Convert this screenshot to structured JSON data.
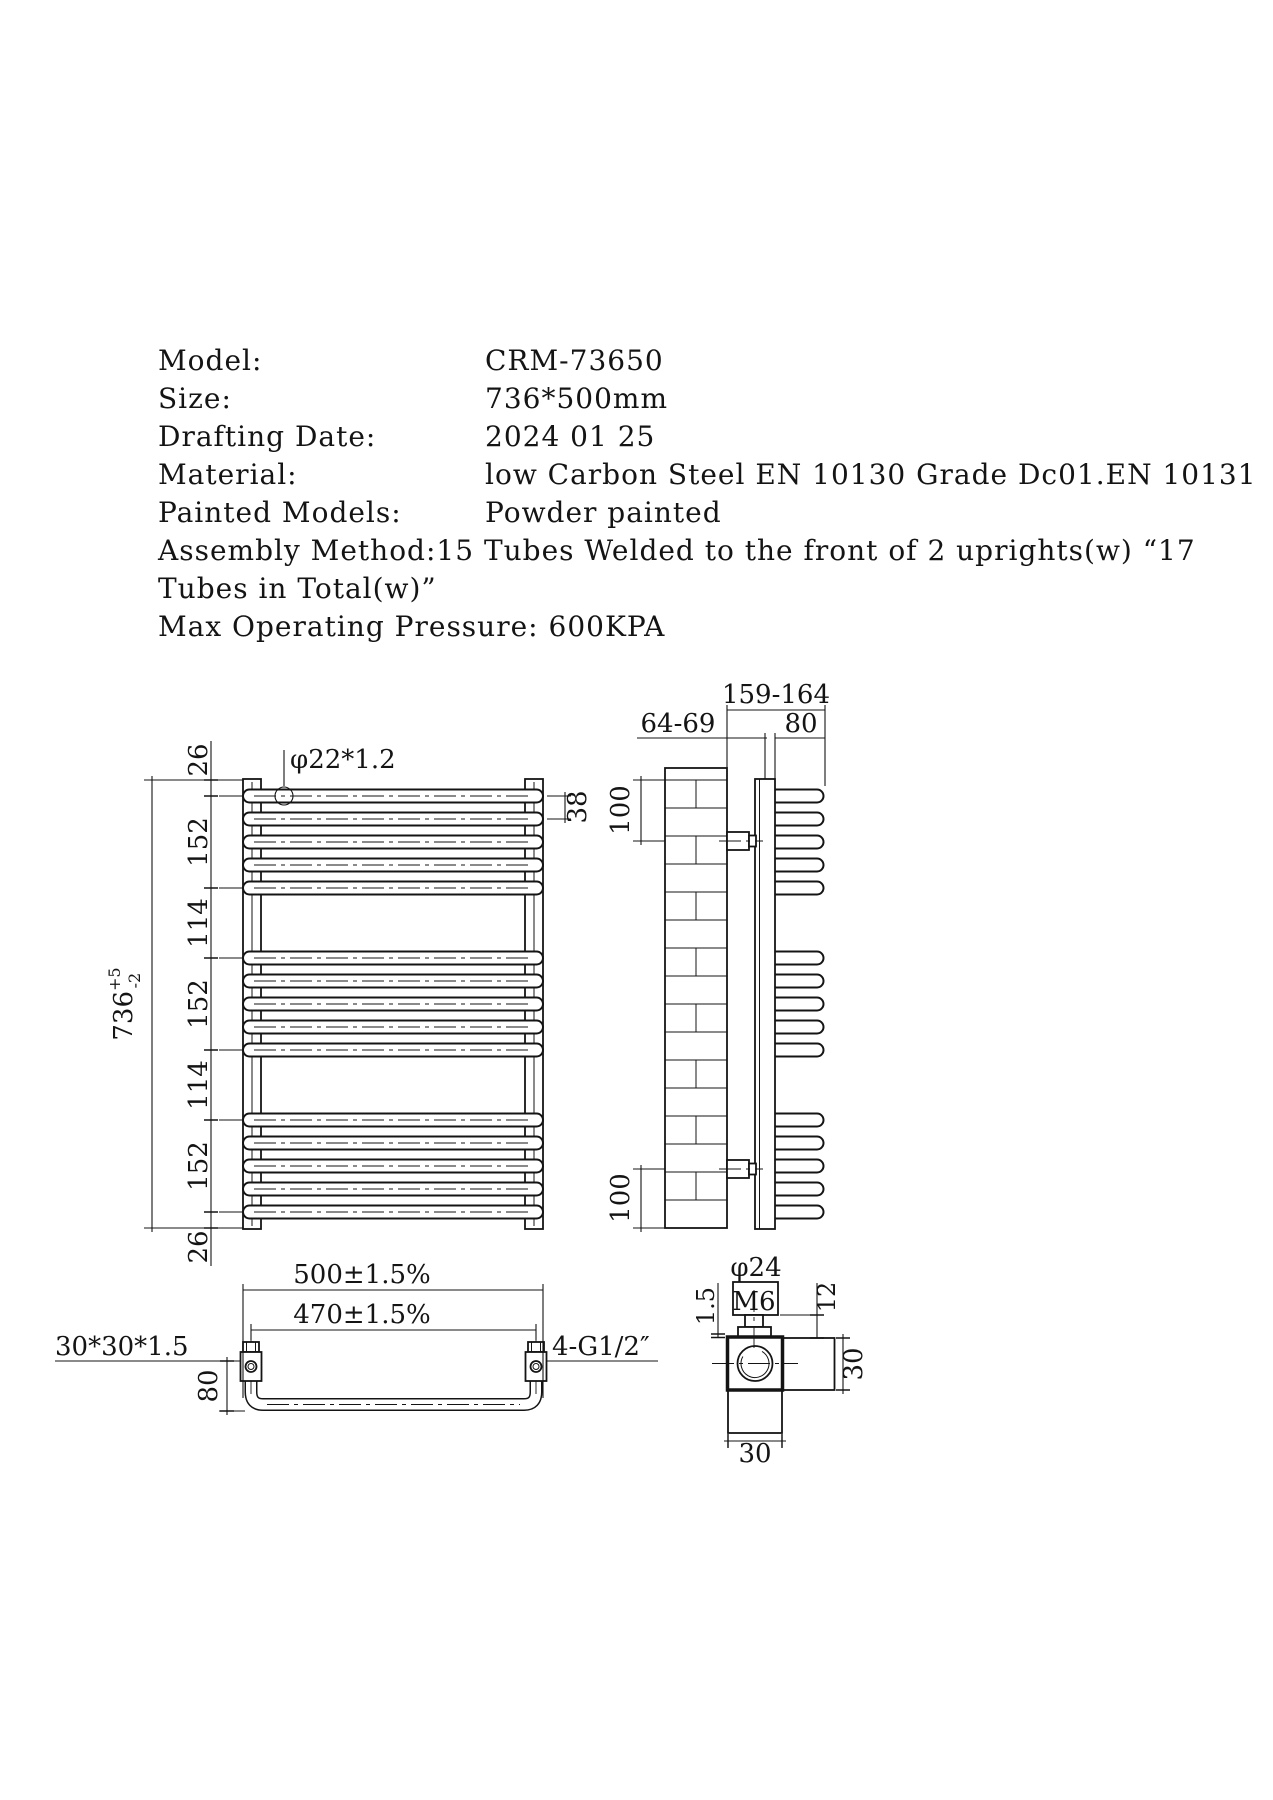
{
  "info": {
    "rows": [
      {
        "label": "Model:",
        "value": "CRM-73650"
      },
      {
        "label": "Size:",
        "value": "736*500mm"
      },
      {
        "label": "Drafting Date:",
        "value": "2024 01 25"
      },
      {
        "label": "Material:",
        "value": "low Carbon Steel EN 10130 Grade Dc01.EN 10131"
      },
      {
        "label": "Painted Models:",
        "value": "Powder painted"
      }
    ],
    "assembly_line1": "Assembly Method:15 Tubes Welded to the front of 2 uprights(w) “17",
    "assembly_line2": "Tubes in Total(w)”",
    "pressure_line": "Max Operating Pressure: 600KPA"
  },
  "front_view": {
    "tube_spec": "φ22*1.2",
    "dim_top": "26",
    "dim_group1": "152",
    "dim_gap1": "114",
    "dim_group2": "152",
    "dim_gap2": "114",
    "dim_group3": "152",
    "dim_bottom": "26",
    "overall_height": "736",
    "height_tol_plus": "+5",
    "height_tol_minus": "-2",
    "tube_pitch": "38"
  },
  "side_view": {
    "dim_total_depth": "159-164",
    "dim_wall_to_upright": "64-69",
    "dim_tube_depth": "80",
    "dim_top_bracket": "100",
    "dim_bottom_bracket": "100"
  },
  "bottom_view": {
    "dim_overall_width": "500±1.5%",
    "dim_centres": "470±1.5%",
    "upright_spec": "30*30*1.5",
    "connection_spec": "4-G1/2″",
    "dim_depth": "80"
  },
  "detail_view": {
    "cap_diameter": "φ24",
    "thread": "M6",
    "plate_thickness": "1.5",
    "bolt_length": "12",
    "dim_width": "30",
    "dim_height": "30"
  },
  "colors": {
    "line": "#141414",
    "background": "#ffffff"
  }
}
